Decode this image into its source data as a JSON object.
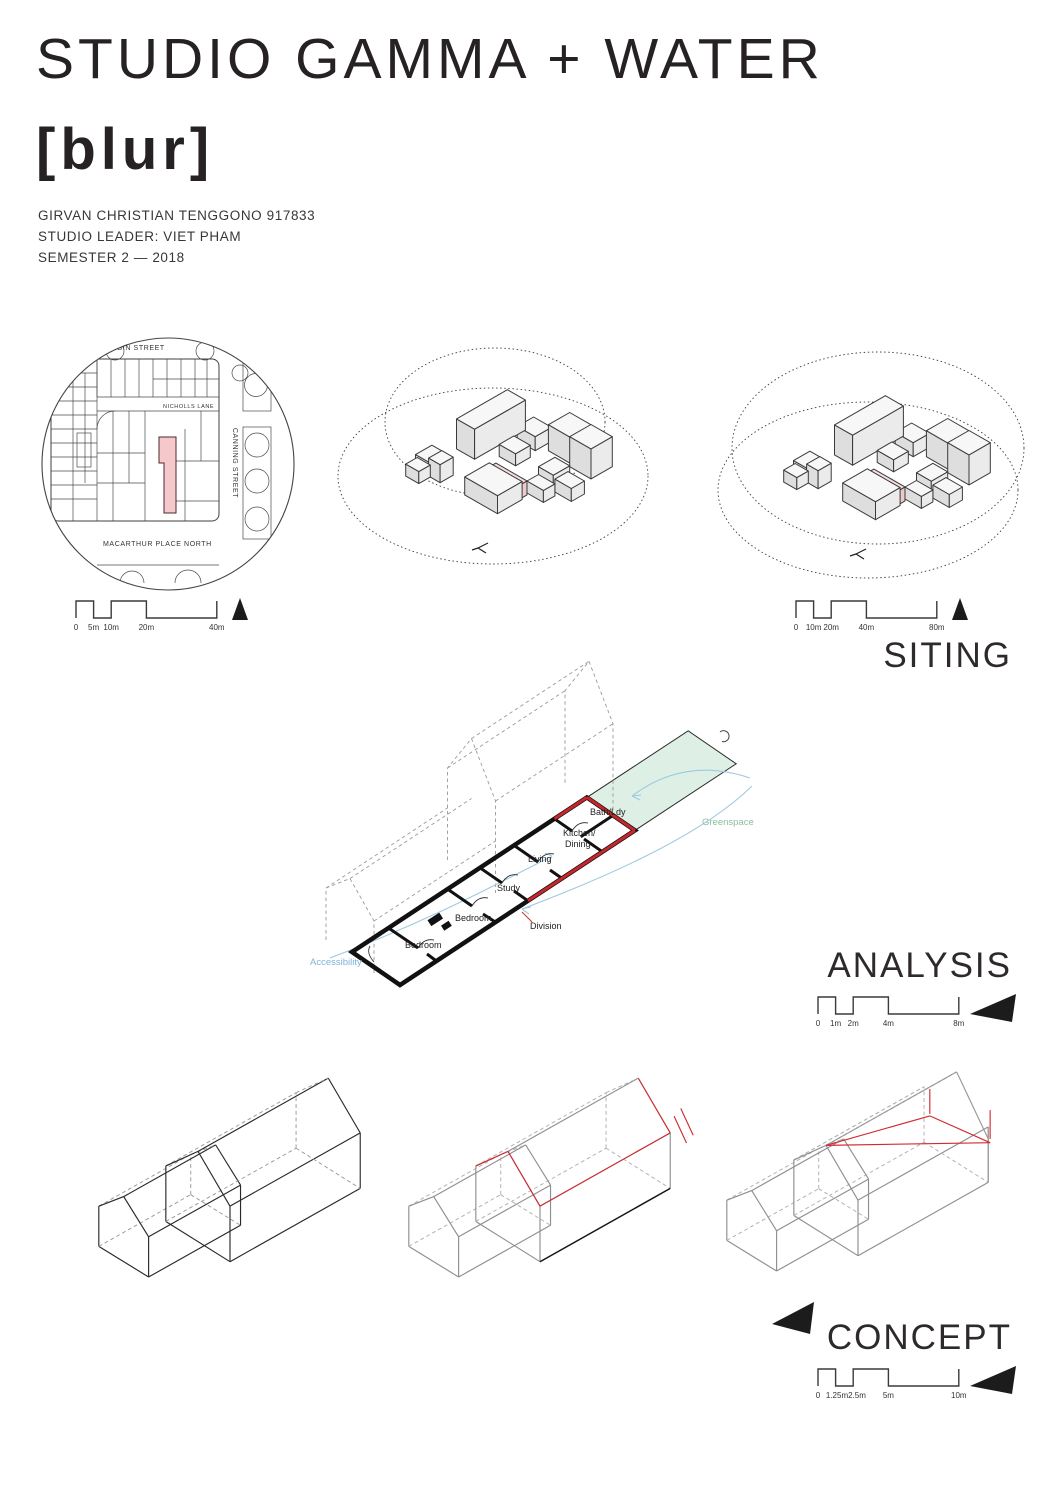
{
  "header": {
    "title": "STUDIO GAMMA + WATER",
    "subtitle": "[blur]",
    "info": {
      "student": "GIRVAN CHRISTIAN TENGGONO 917833",
      "leader": "STUDIO LEADER: VIET PHAM",
      "semester": "SEMESTER 2 — 2018"
    }
  },
  "siting": {
    "heading": "SITING",
    "site_plan": {
      "street_top": "ELGIN STREET",
      "lane": "NICHOLLS LANE",
      "street_right": "CANNING STREET",
      "street_bottom": "MACARTHUR PLACE NORTH",
      "site_fill": "#f5c9cb"
    },
    "scale_bar_left": {
      "ticks": [
        "0",
        "5m",
        "10m",
        "20m",
        "40m"
      ]
    },
    "scale_bar_right": {
      "ticks": [
        "0",
        "10m",
        "20m",
        "40m",
        "80m"
      ]
    }
  },
  "analysis": {
    "heading": "ANALYSIS",
    "rooms": {
      "bath": "Bath/Ldy",
      "kitchen_line1": "Kitchen/",
      "kitchen_line2": "Dining",
      "living": "Living",
      "study": "Study",
      "bedroom_large": "Bedroom",
      "bedroom_small": "Bedroom"
    },
    "annotations": {
      "division": "Division",
      "greenspace": "Greenspace",
      "accessibility": "Accessibility"
    },
    "colors": {
      "division": "#c8262b",
      "greenspace_fill": "#def0e6",
      "greenspace_text": "#8cc09e",
      "flow": "#9fcade"
    },
    "scale_bar": {
      "ticks": [
        "0",
        "1m",
        "2m",
        "4m",
        "8m"
      ]
    }
  },
  "concept": {
    "heading": "CONCEPT",
    "accent": "#d02c30",
    "scale_bar": {
      "ticks": [
        "0",
        "1.25m",
        "2.5m",
        "5m",
        "10m"
      ]
    }
  }
}
